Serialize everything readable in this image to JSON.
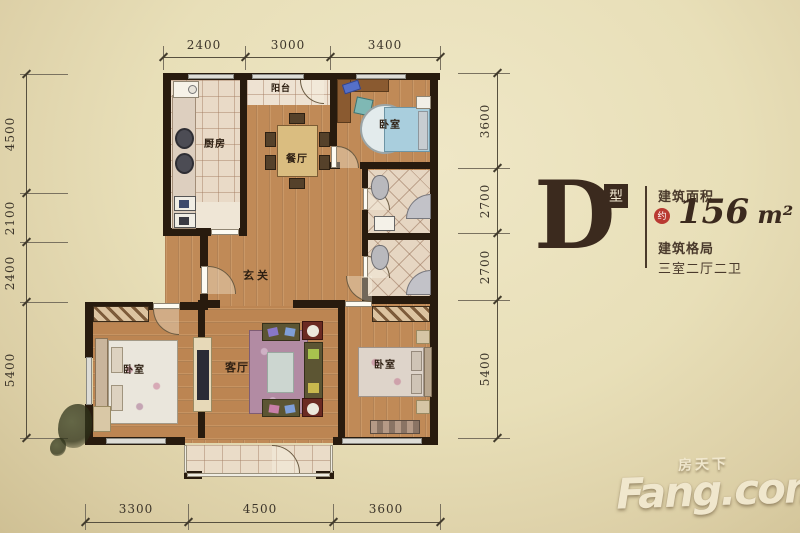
{
  "info_panel": {
    "type_letter": "D",
    "type_suffix": "型",
    "area_label": "建筑面积",
    "area_approx": "约",
    "area_value": "156",
    "area_unit": " m²",
    "layout_label": "建筑格局",
    "layout_value": "三室二厅二卫"
  },
  "rooms": {
    "balcony_top": "阳台",
    "kitchen": "厨房",
    "dining": "餐厅",
    "bedroom_top_right": "卧室",
    "hallway": "玄关",
    "living": "客厅",
    "bedroom_bottom_left": "卧室",
    "bedroom_bottom_right": "卧室"
  },
  "dimensions": {
    "top": [
      "2400",
      "3000",
      "3400"
    ],
    "left": [
      "4500",
      "2100",
      "2400",
      "5400"
    ],
    "right": [
      "3600",
      "2700",
      "2700",
      "5400"
    ],
    "bottom": [
      "3300",
      "4500",
      "3600"
    ]
  },
  "watermark": {
    "brand": "Fang.com",
    "brand_cn": "房天下"
  },
  "colors": {
    "background": "#e8dfb8",
    "wall": "#281b0e",
    "wood_floor": "#c08a57",
    "tile_floor": "#e9dac7",
    "accent_red": "#b93a32",
    "text_brown": "#3b2a1e"
  }
}
